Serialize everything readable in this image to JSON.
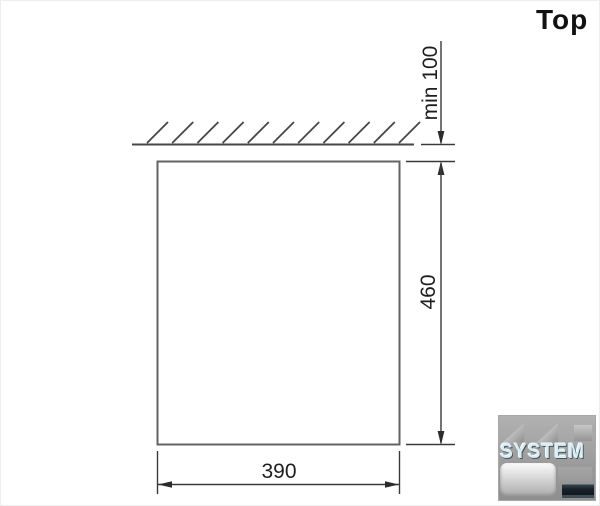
{
  "header": {
    "view_label": "Top"
  },
  "diagram": {
    "type": "installation-clearance-top-view",
    "dimensions": {
      "top_clearance": {
        "label": "min 100"
      },
      "depth": {
        "label": "460"
      },
      "width": {
        "label": "390"
      }
    },
    "colors": {
      "hatch_line": "#474747",
      "unit_outline": "#636363",
      "dimension_line": "#3a3a3a",
      "text": "#1e1e1e"
    }
  },
  "watermark": {
    "brand": "SYSTEM",
    "base_color": "#9c9c9c",
    "brand_color": "#d9edf5"
  }
}
